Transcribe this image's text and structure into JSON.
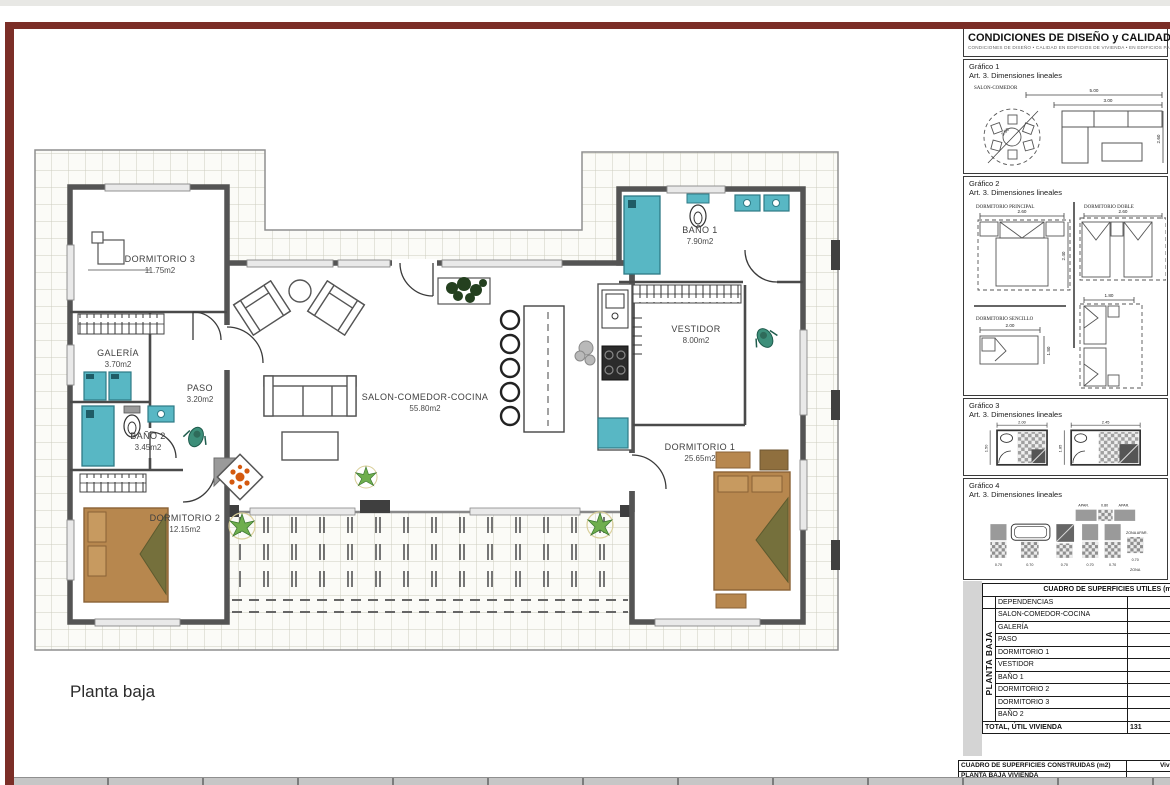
{
  "caption": "Planta baja",
  "rooms": {
    "dormitorio3": {
      "name": "DORMITORIO 3",
      "area": "11.75m2"
    },
    "galeria": {
      "name": "GALERÍA",
      "area": "3.70m2"
    },
    "paso": {
      "name": "PASO",
      "area": "3.20m2"
    },
    "bano2": {
      "name": "BAÑO 2",
      "area": "3.45m2"
    },
    "dormitorio2": {
      "name": "DORMITORIO 2",
      "area": "12.15m2"
    },
    "salon": {
      "name": "SALON-COMEDOR-COCINA",
      "area": "55.80m2"
    },
    "bano1": {
      "name": "BAÑO 1",
      "area": "7.90m2"
    },
    "vestidor": {
      "name": "VESTIDOR",
      "area": "8.00m2"
    },
    "dormitorio1": {
      "name": "DORMITORIO 1",
      "area": "25.65m2"
    }
  },
  "panel": {
    "header": {
      "title": "CONDICIONES DE DISEÑO y CALIDAD (DC-0",
      "subtitle": "CONDICIONES DE DISEÑO • CALIDAD EN EDIFICIOS DE VIVIENDA • EN EDIFICIOS PARA ALOJAM"
    },
    "g1": {
      "title": "Gráfico 1",
      "subtitle": "Art. 3. Dimensiones lineales",
      "room": "SALON-COMEDOR",
      "dim_a": "5.00",
      "dim_b": "3.00",
      "dim_c": "2.60",
      "dim_d": "2.50"
    },
    "g2": {
      "title": "Gráfico 2",
      "subtitle": "Art. 3. Dimensiones lineales",
      "principal": {
        "label": "DORMITORIO PRINCIPAL",
        "w": "2.60",
        "h": "2.40"
      },
      "doble": {
        "label": "DORMITORIO DOBLE",
        "w": "2.60"
      },
      "sencillo": {
        "label": "DORMITORIO SENCILLO",
        "w": "2.00",
        "h": "1.80"
      },
      "doble2": {
        "w": "1.80"
      }
    },
    "g3": {
      "title": "Gráfico 3",
      "subtitle": "Art. 3. Dimensiones lineales",
      "bath1": {
        "w": "2.00",
        "h": "1.50"
      },
      "bath2": {
        "w": "2.45",
        "h": "1.85"
      }
    },
    "g4": {
      "title": "Gráfico 4",
      "subtitle": "Art. 3. Dimensiones lineales",
      "top_a": "APAR.",
      "top_b": "0.80",
      "top_c": "APAR.",
      "d1": "0.70",
      "d2": "0.70",
      "d3": "0.70",
      "d4": "0.70",
      "d5": "0.70",
      "zona_apar": "ZONA APAR.",
      "zona": "ZONA",
      "d6": "0.70"
    },
    "utiles": {
      "title": "CUADRO DE SUPERFICIES UTILES (m",
      "col_dep": "DEPENDENCIAS",
      "col_viv": "Vivien",
      "side": "PLANTA BAJA",
      "rows": [
        "SALON-COMEDOR-COCINA",
        "GALERÍA",
        "PASO",
        "DORMITORIO 1",
        "VESTIDOR",
        "BAÑO 1",
        "DORMITORIO 2",
        "DORMITORIO 3",
        "BAÑO 2"
      ],
      "total_label": "TOTAL, ÚTIL VIVIENDA",
      "total_value": "131"
    },
    "construidas": {
      "title": "CUADRO DE SUPERFICIES CONSTRUIDAS (m2)",
      "col_viv": "Vivie",
      "rows": [
        {
          "label": "PLANTA BAJA VIVIENDA",
          "value": "1"
        },
        {
          "label": "TOTAL, SUPERFICIE CONSTRUIDA VIVIENDA",
          "value": "1"
        },
        {
          "label": "SUPERFICIE CONSTRUIDA, ANEXO GARAJE",
          "value": ""
        },
        {
          "label": "TOTAL, CONSTRUIDA EDIFICACIÓN",
          "value": ""
        }
      ]
    }
  },
  "colors": {
    "frame": "#7b2e27",
    "teal": "#58b7c4",
    "bed": "#b7874e",
    "accent": "#d4590f"
  }
}
